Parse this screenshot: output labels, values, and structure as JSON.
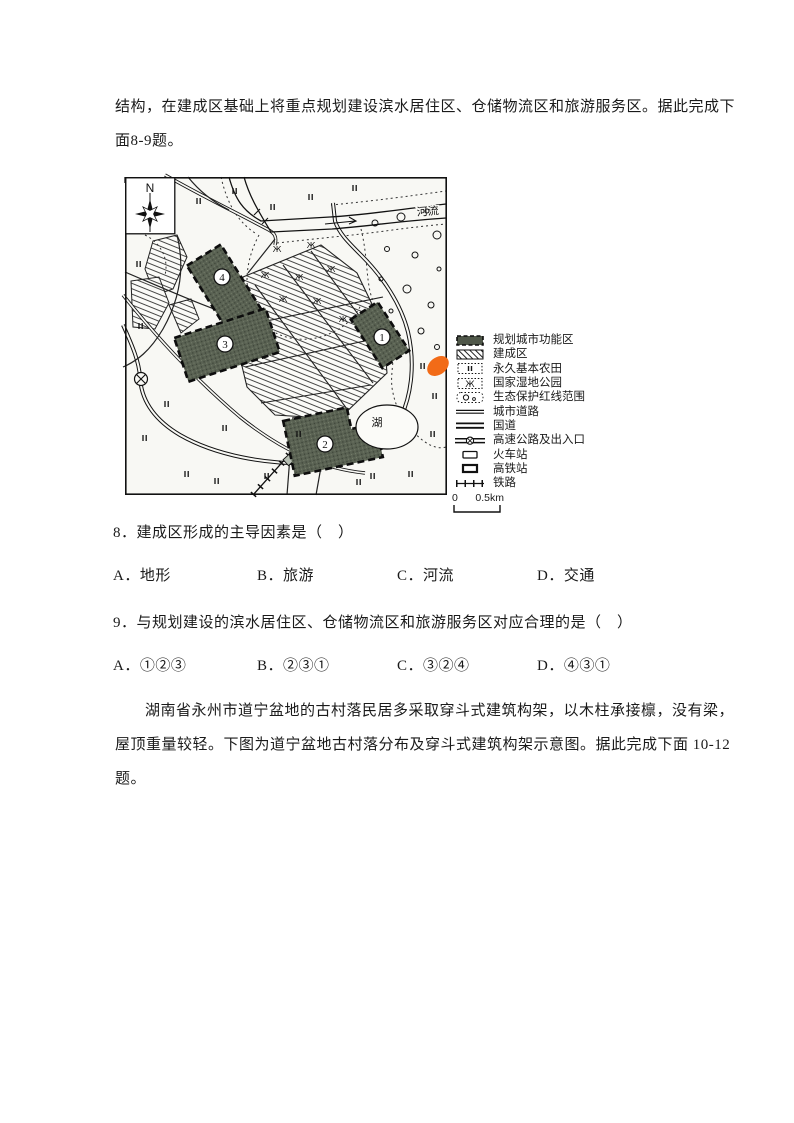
{
  "intro_8_9": {
    "lines": [
      "结构，在建成区基础上将重点规划建设滨水居住区、仓储物流区和旅游服务区。据此完成下",
      "面8-9题。"
    ]
  },
  "map": {
    "north_label": "N",
    "river_label": "河流",
    "lake_label": "湖",
    "zone_numbers": [
      "1",
      "2",
      "3",
      "4"
    ],
    "marker_color": "#f26b17",
    "ink_color": "#1a1a1a",
    "zone_fill": "#525a4b"
  },
  "legend": {
    "items": [
      {
        "key": "planned-zone",
        "label": "规划城市功能区"
      },
      {
        "key": "built-up-area",
        "label": "建成区"
      },
      {
        "key": "farmland",
        "label": "永久基本农田"
      },
      {
        "key": "wetland-park",
        "label": "国家湿地公园"
      },
      {
        "key": "eco-redline",
        "label": "生态保护红线范围"
      },
      {
        "key": "city-road",
        "label": "城市道路"
      },
      {
        "key": "national-road",
        "label": "国道"
      },
      {
        "key": "expressway",
        "label": "高速公路及出入口"
      },
      {
        "key": "railway-station",
        "label": "火车站"
      },
      {
        "key": "hsr-station",
        "label": "高铁站"
      },
      {
        "key": "railway",
        "label": "铁路"
      }
    ],
    "scale": {
      "zero": "0",
      "distance": "0.5km"
    }
  },
  "questions": [
    {
      "stem": "8．建成区形成的主导因素是（　）",
      "options": [
        "A．地形",
        "B．旅游",
        "C．河流",
        "D．交通"
      ]
    },
    {
      "stem": "9．与规划建设的滨水居住区、仓储物流区和旅游服务区对应合理的是（　）",
      "options": [
        "A．①②③",
        "B．②③①",
        "C．③②④",
        "D．④③①"
      ]
    }
  ],
  "intro_10_12": {
    "lines": [
      "湖南省永州市道宁盆地的古村落民居多采取穿斗式建筑构架，以木柱承接檩，没有梁，",
      "屋顶重量较轻。下图为道宁盆地古村落分布及穿斗式建筑构架示意图。据此完成下面 10-12",
      "题。"
    ]
  }
}
